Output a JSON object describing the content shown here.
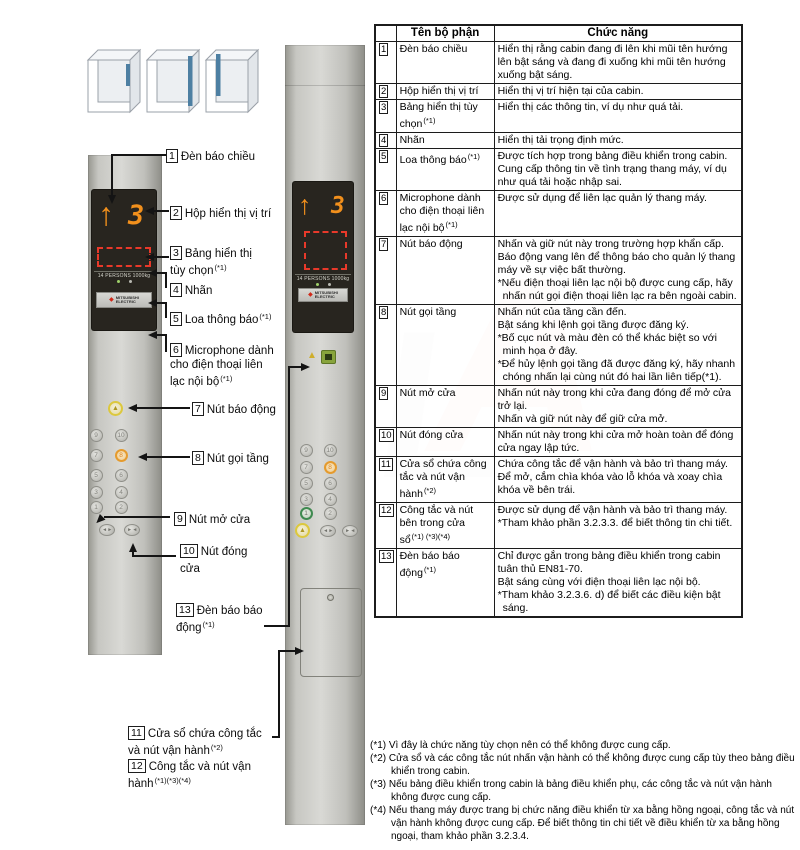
{
  "figure": {
    "labels": [
      {
        "num": "1",
        "text": "Đèn báo chiều",
        "sup": ""
      },
      {
        "num": "2",
        "text": "Hộp hiển thị vị trí",
        "sup": ""
      },
      {
        "num": "3",
        "text": "Bảng hiển thị tùy chọn",
        "sup": "(*1)"
      },
      {
        "num": "4",
        "text": "Nhãn",
        "sup": ""
      },
      {
        "num": "5",
        "text": "Loa thông báo",
        "sup": "(*1)"
      },
      {
        "num": "6",
        "text": "Microphone dành cho điện thoại liên lạc nội bộ",
        "sup": "(*1)"
      },
      {
        "num": "7",
        "text": "Nút báo động",
        "sup": ""
      },
      {
        "num": "8",
        "text": "Nút gọi tầng",
        "sup": ""
      },
      {
        "num": "9",
        "text": "Nút mở cửa",
        "sup": ""
      },
      {
        "num": "10",
        "text": "Nút đóng cửa",
        "sup": ""
      },
      {
        "num": "13",
        "text": "Đèn báo báo động",
        "sup": "(*1)"
      },
      {
        "num": "11",
        "text": "Cửa sổ chứa công tắc và nút vận hành",
        "sup": "(*2)"
      },
      {
        "num": "12",
        "text": "Công tắc và nút vận hành",
        "sup": "(*1)(*3)(*4)"
      }
    ],
    "panels": {
      "display": {
        "arrow": "↑",
        "floor": "3",
        "capacity_label": "14 PERSONS 1000kg",
        "brand_line1": "MITSUBISHI",
        "brand_line2": "ELECTRIC",
        "brand_mark": "◆"
      },
      "floor_buttons": [
        [
          "9",
          "10"
        ],
        [
          "7",
          "8"
        ],
        [
          "5",
          "6"
        ],
        [
          "3",
          "4"
        ],
        [
          "1",
          "2"
        ]
      ],
      "highlight_orange": "8",
      "highlight_green": "1",
      "alarm_icon": "▲",
      "door_open_icon": "◄ ►",
      "door_close_icon": "► ◄"
    },
    "colors": {
      "segment_orange": "#f2901c",
      "option_red": "#e8392a",
      "alarm_yellow": "#dcc83d",
      "call_registered_orange": "#e59b2e",
      "green_ring": "#3f8a50"
    }
  },
  "table": {
    "headers": {
      "name": "Tên bộ phận",
      "func": "Chức năng"
    },
    "rows": [
      {
        "num": "1",
        "name": "Đèn báo chiều",
        "sup": "",
        "func": [
          "Hiển thị rằng cabin đang đi lên khi mũi tên hướng lên bật sáng và đang đi xuống khi mũi tên hướng xuống bật sáng."
        ]
      },
      {
        "num": "2",
        "name": "Hộp hiển thị vị trí",
        "sup": "",
        "func": [
          "Hiển thị vị trí hiện tại của cabin."
        ]
      },
      {
        "num": "3",
        "name": "Bảng hiển thị tùy chọn",
        "sup": "(*1)",
        "func": [
          "Hiển thị các thông tin, ví dụ như quá tải."
        ]
      },
      {
        "num": "4",
        "name": "Nhãn",
        "sup": "",
        "func": [
          "Hiển thị tải trọng định mức."
        ]
      },
      {
        "num": "5",
        "name": "Loa thông báo",
        "sup": "(*1)",
        "func": [
          "Được tích hợp trong bảng điều khiển trong cabin.",
          "Cung cấp thông tin về tình trạng thang máy, ví dụ như quá tải hoặc nhập sai."
        ]
      },
      {
        "num": "6",
        "name": "Microphone dành cho điện thoại liên lạc nội bộ",
        "sup": "(*1)",
        "func": [
          "Được sử dụng để liên lạc quản lý thang máy."
        ]
      },
      {
        "num": "7",
        "name": "Nút báo động",
        "sup": "",
        "func": [
          "Nhấn và giữ nút này trong trường hợp khẩn cấp.",
          "Báo động vang lên để thông báo cho quản lý thang máy về sự việc bất thường.",
          "*Nếu điện thoại liên lạc nội bộ được cung cấp, hãy nhấn nút gọi điện thoại liên lạc ra bên ngoài cabin."
        ]
      },
      {
        "num": "8",
        "name": "Nút gọi tầng",
        "sup": "",
        "func": [
          "Nhấn nút của tầng cần đến.",
          "Bật sáng khi lệnh gọi tầng được đăng ký.",
          "*Bố cục nút và màu đèn có thể khác biệt so với minh họa ở đây.",
          "*Để hủy lệnh gọi tầng đã được đăng ký, hãy nhanh chóng nhấn lại cùng nút đó hai lần liên tiếp(*1)."
        ]
      },
      {
        "num": "9",
        "name": "Nút mở cửa",
        "sup": "",
        "func": [
          "Nhấn nút này trong khi cửa đang đóng để mở cửa trở lại.",
          "Nhấn và giữ nút này để giữ cửa mở."
        ]
      },
      {
        "num": "10",
        "name": "Nút đóng cửa",
        "sup": "",
        "func": [
          "Nhấn nút này trong khi cửa mở hoàn toàn để đóng cửa ngay lập tức."
        ]
      },
      {
        "num": "11",
        "name": "Cửa sổ chứa công tắc và nút vận hành",
        "sup": "(*2)",
        "func": [
          "Chứa công tắc để vận hành và bảo trì thang máy.",
          "Để mở, cắm chìa khóa vào lỗ khóa và xoay chìa khóa về bên trái."
        ]
      },
      {
        "num": "12",
        "name": "Công tắc và nút bên trong cửa sổ",
        "sup": "(*1) (*3)(*4)",
        "func": [
          "Được sử dụng để vận hành và bảo trì thang máy.",
          "*Tham khảo phần 3.2.3.3. để biết thông tin chi tiết."
        ]
      },
      {
        "num": "13",
        "name": "Đèn báo báo động",
        "sup": "(*1)",
        "func": [
          "Chỉ được gắn trong bảng điều khiển trong cabin tuân thủ EN81-70.",
          "Bật sáng cùng với điện thoại liên lạc nội bộ.",
          "*Tham khảo 3.2.3.6. d) để biết các điều kiện bật sáng."
        ]
      }
    ]
  },
  "footnotes": [
    "(*1) Vì đây là chức năng tùy chọn nên có thể không được cung cấp.",
    "(*2) Cửa sổ và các công tắc nút nhấn vận hành có thể không được cung cấp tùy theo bảng điều khiển trong cabin.",
    "(*3) Nếu bảng điều khiển trong cabin là bảng điều khiển phụ, các công tắc và nút vận hành không được cung cấp.",
    "(*4) Nếu thang máy được trang bị chức năng điều khiển từ xa bằng hồng ngoại, công tắc và nút vận hành không được cung cấp. Để biết thông tin chi tiết về điều khiển từ xa bằng hồng ngoại, tham khảo phần 3.2.3.4."
  ],
  "watermark": {
    "letter1": "A",
    "letter2": "L"
  }
}
